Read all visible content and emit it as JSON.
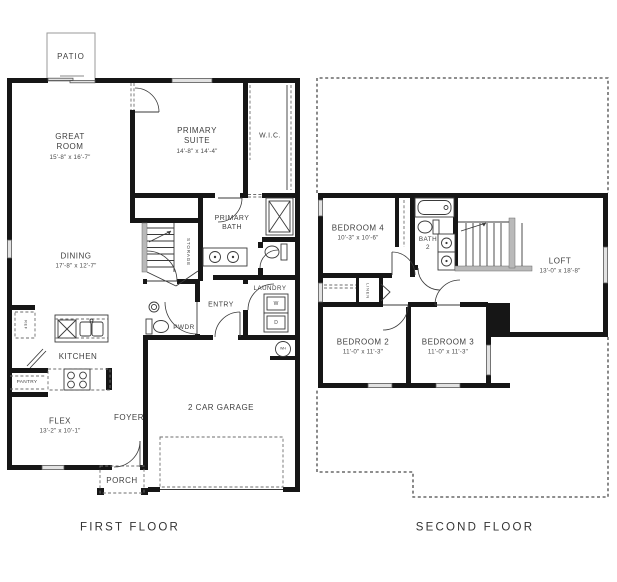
{
  "colors": {
    "wall": "#161616",
    "line": "#3a3a3a",
    "dash": "#6e6e6e",
    "win": "#e2e2e2",
    "text": "#414141",
    "bg": "#ffffff"
  },
  "first_floor": {
    "caption": "FIRST FLOOR",
    "rooms": {
      "patio": {
        "label": "PATIO"
      },
      "great_room": {
        "label": "GREAT ROOM",
        "dims": "15'-8\" x 16'-7\""
      },
      "primary_suite": {
        "label": "PRIMARY SUITE",
        "dims": "14'-8\" x 14'-4\""
      },
      "wic": {
        "label": "W.I.C."
      },
      "primary_bath": {
        "label": "PRIMARY BATH"
      },
      "storage": {
        "label": "STORAGE"
      },
      "dining": {
        "label": "DINING",
        "dims": "17'-8\" x 12'-7\""
      },
      "laundry": {
        "label": "LAUNDRY"
      },
      "entry": {
        "label": "ENTRY"
      },
      "pwdr": {
        "label": "PWDR"
      },
      "kitchen": {
        "label": "KITCHEN"
      },
      "pantry": {
        "label": "PANTRY"
      },
      "ref": {
        "label": "REF"
      },
      "flex": {
        "label": "FLEX",
        "dims": "13'-2\" x 10'-1\""
      },
      "foyer": {
        "label": "FOYER"
      },
      "garage": {
        "label": "2 CAR GARAGE"
      },
      "porch": {
        "label": "PORCH"
      }
    },
    "appliances": {
      "washer": "W",
      "dryer": "D",
      "water_heater": "WH"
    }
  },
  "second_floor": {
    "caption": "SECOND FLOOR",
    "rooms": {
      "bedroom4": {
        "label": "BEDROOM 4",
        "dims": "10'-3\" x 10'-6\""
      },
      "bath2": {
        "label": "BATH",
        "number": "2"
      },
      "loft": {
        "label": "LOFT",
        "dims": "13'-0\" x 18'-8\""
      },
      "linen": {
        "label": "LINEN"
      },
      "bedroom2": {
        "label": "BEDROOM 2",
        "dims": "11'-0\" x 11'-3\""
      },
      "bedroom3": {
        "label": "BEDROOM 3",
        "dims": "11'-0\" x 11'-3\""
      }
    }
  }
}
